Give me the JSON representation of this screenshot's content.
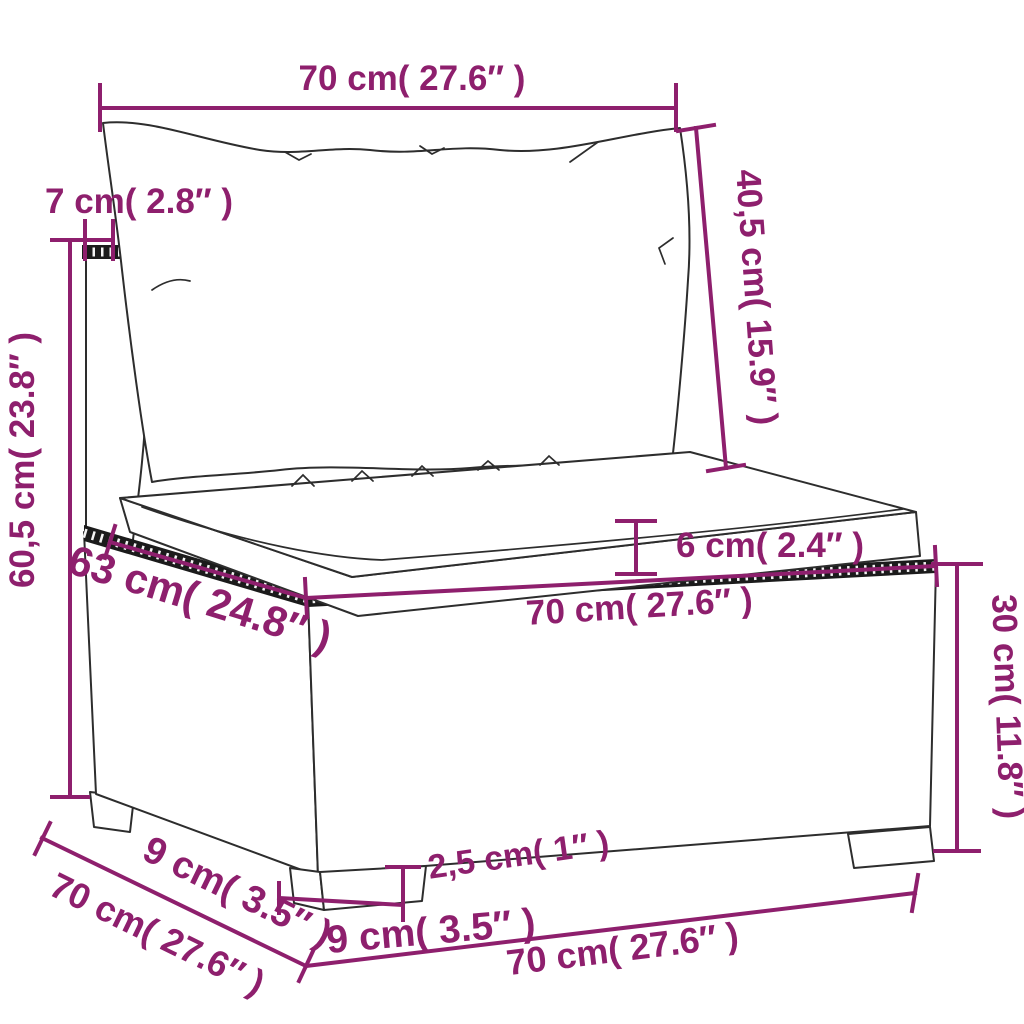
{
  "diagram": {
    "kind": "product-dimension-line-drawing",
    "labels": {
      "back_width_top": "70 cm( 27.6″ )",
      "back_frame_depth": "7 cm( 2.8″ )",
      "back_cushion_height": "40,5 cm( 15.9″ )",
      "back_total_height": "60,5 cm( 23.8″ )",
      "seat_depth": "63 cm( 24.8″ )",
      "seat_cushion_thickness": "6 cm( 2.4″ )",
      "seat_width": "70 cm( 27.6″ )",
      "base_height": "30 cm( 11.8″ )",
      "foot_height": "2,5 cm( 1″ )",
      "foot_width": "9 cm( 3.5″ )",
      "foot_side_offset": "9 cm( 3.5″ )",
      "side_depth_bottom": "70 cm( 27.6″ )",
      "front_width_bottom": "70 cm( 27.6″ )"
    },
    "colors": {
      "dimension": "#8E1F6D",
      "line_art": "#2D2D2D",
      "rattan_trim": "#1B1B1B",
      "background": "#FFFFFF"
    }
  }
}
